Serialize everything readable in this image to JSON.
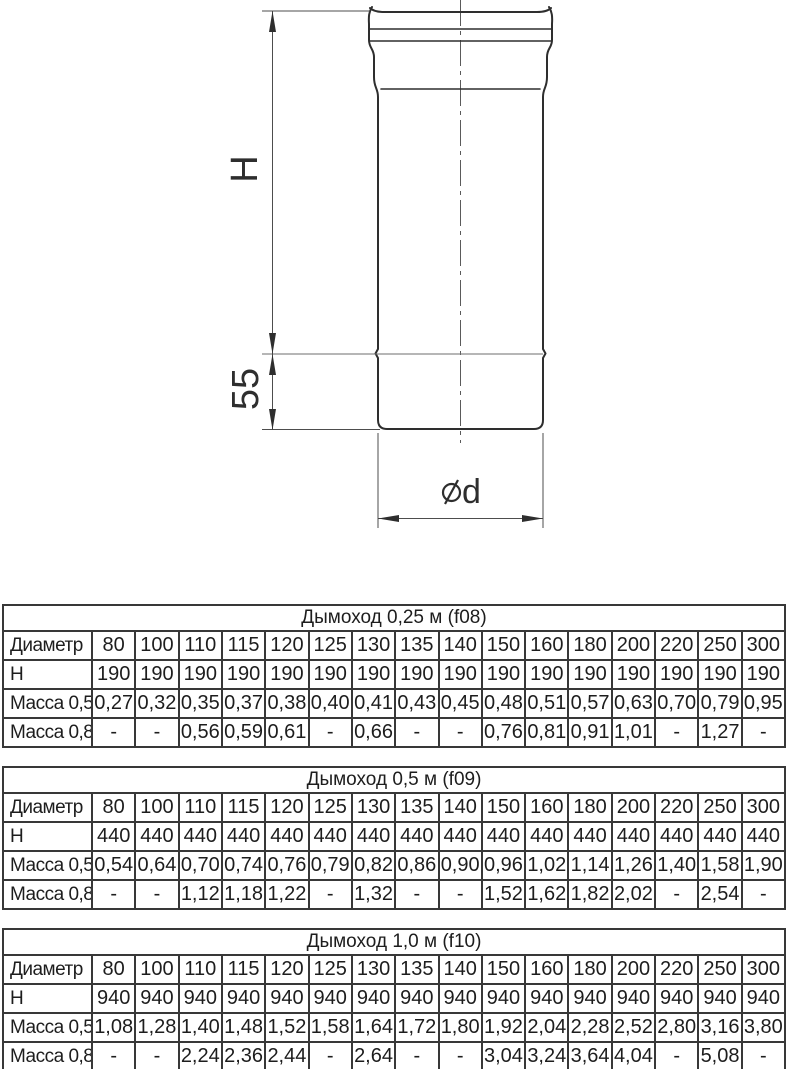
{
  "drawing": {
    "labels": {
      "height": "H",
      "socket_depth": "55",
      "diameter_letter": "d"
    },
    "line_color": "#2e2e2e",
    "dim_color": "#4d4d4d"
  },
  "tables": [
    {
      "title": "Дымоход 0,25 м (f08)",
      "rows": [
        {
          "label": "Диаметр",
          "values": [
            "80",
            "100",
            "110",
            "115",
            "120",
            "125",
            "130",
            "135",
            "140",
            "150",
            "160",
            "180",
            "200",
            "220",
            "250",
            "300"
          ]
        },
        {
          "label": "H",
          "values": [
            "190",
            "190",
            "190",
            "190",
            "190",
            "190",
            "190",
            "190",
            "190",
            "190",
            "190",
            "190",
            "190",
            "190",
            "190",
            "190"
          ]
        },
        {
          "label": "Масса 0,5",
          "values": [
            "0,27",
            "0,32",
            "0,35",
            "0,37",
            "0,38",
            "0,40",
            "0,41",
            "0,43",
            "0,45",
            "0,48",
            "0,51",
            "0,57",
            "0,63",
            "0,70",
            "0,79",
            "0,95"
          ]
        },
        {
          "label": "Масса 0,8",
          "values": [
            "-",
            "-",
            "0,56",
            "0,59",
            "0,61",
            "-",
            "0,66",
            "-",
            "-",
            "0,76",
            "0,81",
            "0,91",
            "1,01",
            "-",
            "1,27",
            "-"
          ]
        }
      ]
    },
    {
      "title": "Дымоход 0,5 м (f09)",
      "rows": [
        {
          "label": "Диаметр",
          "values": [
            "80",
            "100",
            "110",
            "115",
            "120",
            "125",
            "130",
            "135",
            "140",
            "150",
            "160",
            "180",
            "200",
            "220",
            "250",
            "300"
          ]
        },
        {
          "label": "H",
          "values": [
            "440",
            "440",
            "440",
            "440",
            "440",
            "440",
            "440",
            "440",
            "440",
            "440",
            "440",
            "440",
            "440",
            "440",
            "440",
            "440"
          ]
        },
        {
          "label": "Масса 0,5",
          "values": [
            "0,54",
            "0,64",
            "0,70",
            "0,74",
            "0,76",
            "0,79",
            "0,82",
            "0,86",
            "0,90",
            "0,96",
            "1,02",
            "1,14",
            "1,26",
            "1,40",
            "1,58",
            "1,90"
          ]
        },
        {
          "label": "Масса 0,8",
          "values": [
            "-",
            "-",
            "1,12",
            "1,18",
            "1,22",
            "-",
            "1,32",
            "-",
            "-",
            "1,52",
            "1,62",
            "1,82",
            "2,02",
            "-",
            "2,54",
            "-"
          ]
        }
      ]
    },
    {
      "title": "Дымоход 1,0 м (f10)",
      "rows": [
        {
          "label": "Диаметр",
          "values": [
            "80",
            "100",
            "110",
            "115",
            "120",
            "125",
            "130",
            "135",
            "140",
            "150",
            "160",
            "180",
            "200",
            "220",
            "250",
            "300"
          ]
        },
        {
          "label": "H",
          "values": [
            "940",
            "940",
            "940",
            "940",
            "940",
            "940",
            "940",
            "940",
            "940",
            "940",
            "940",
            "940",
            "940",
            "940",
            "940",
            "940"
          ]
        },
        {
          "label": "Масса 0,5",
          "values": [
            "1,08",
            "1,28",
            "1,40",
            "1,48",
            "1,52",
            "1,58",
            "1,64",
            "1,72",
            "1,80",
            "1,92",
            "2,04",
            "2,28",
            "2,52",
            "2,80",
            "3,16",
            "3,80"
          ]
        },
        {
          "label": "Масса 0,8",
          "values": [
            "-",
            "-",
            "2,24",
            "2,36",
            "2,44",
            "-",
            "2,64",
            "-",
            "-",
            "3,04",
            "3,24",
            "3,64",
            "4,04",
            "-",
            "5,08",
            "-"
          ]
        }
      ]
    }
  ]
}
